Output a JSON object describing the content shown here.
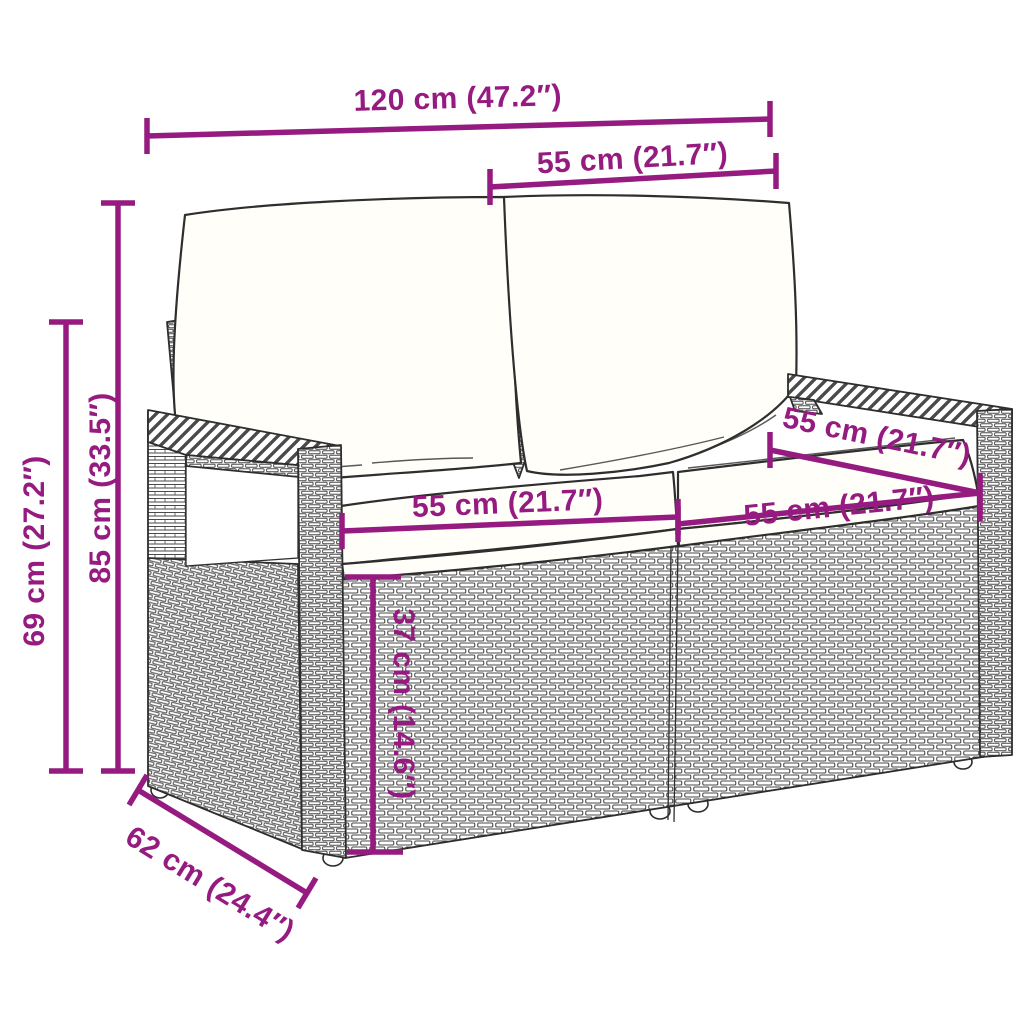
{
  "title": "Garden loveseat dimension diagram",
  "colors": {
    "accent": "#951b81",
    "ink": "#2e2e2e",
    "weave": "#4a4a4a",
    "cushion": "#fffef9",
    "background": "#ffffff"
  },
  "dimensions": [
    {
      "id": "total-width",
      "label": "120 cm (47.2″)"
    },
    {
      "id": "back-cushion-width",
      "label": "55 cm (21.7″)"
    },
    {
      "id": "total-height",
      "label": "85 cm (33.5″)"
    },
    {
      "id": "armrest-height",
      "label": "69 cm (27.2″)"
    },
    {
      "id": "seat-width-left",
      "label": "55 cm (21.7″)"
    },
    {
      "id": "seat-width-right",
      "label": "55 cm (21.7″)"
    },
    {
      "id": "seat-depth",
      "label": "55 cm (21.7″)"
    },
    {
      "id": "seat-height",
      "label": "37 cm (14.6″)"
    },
    {
      "id": "total-depth",
      "label": "62 cm (24.4″)"
    }
  ]
}
